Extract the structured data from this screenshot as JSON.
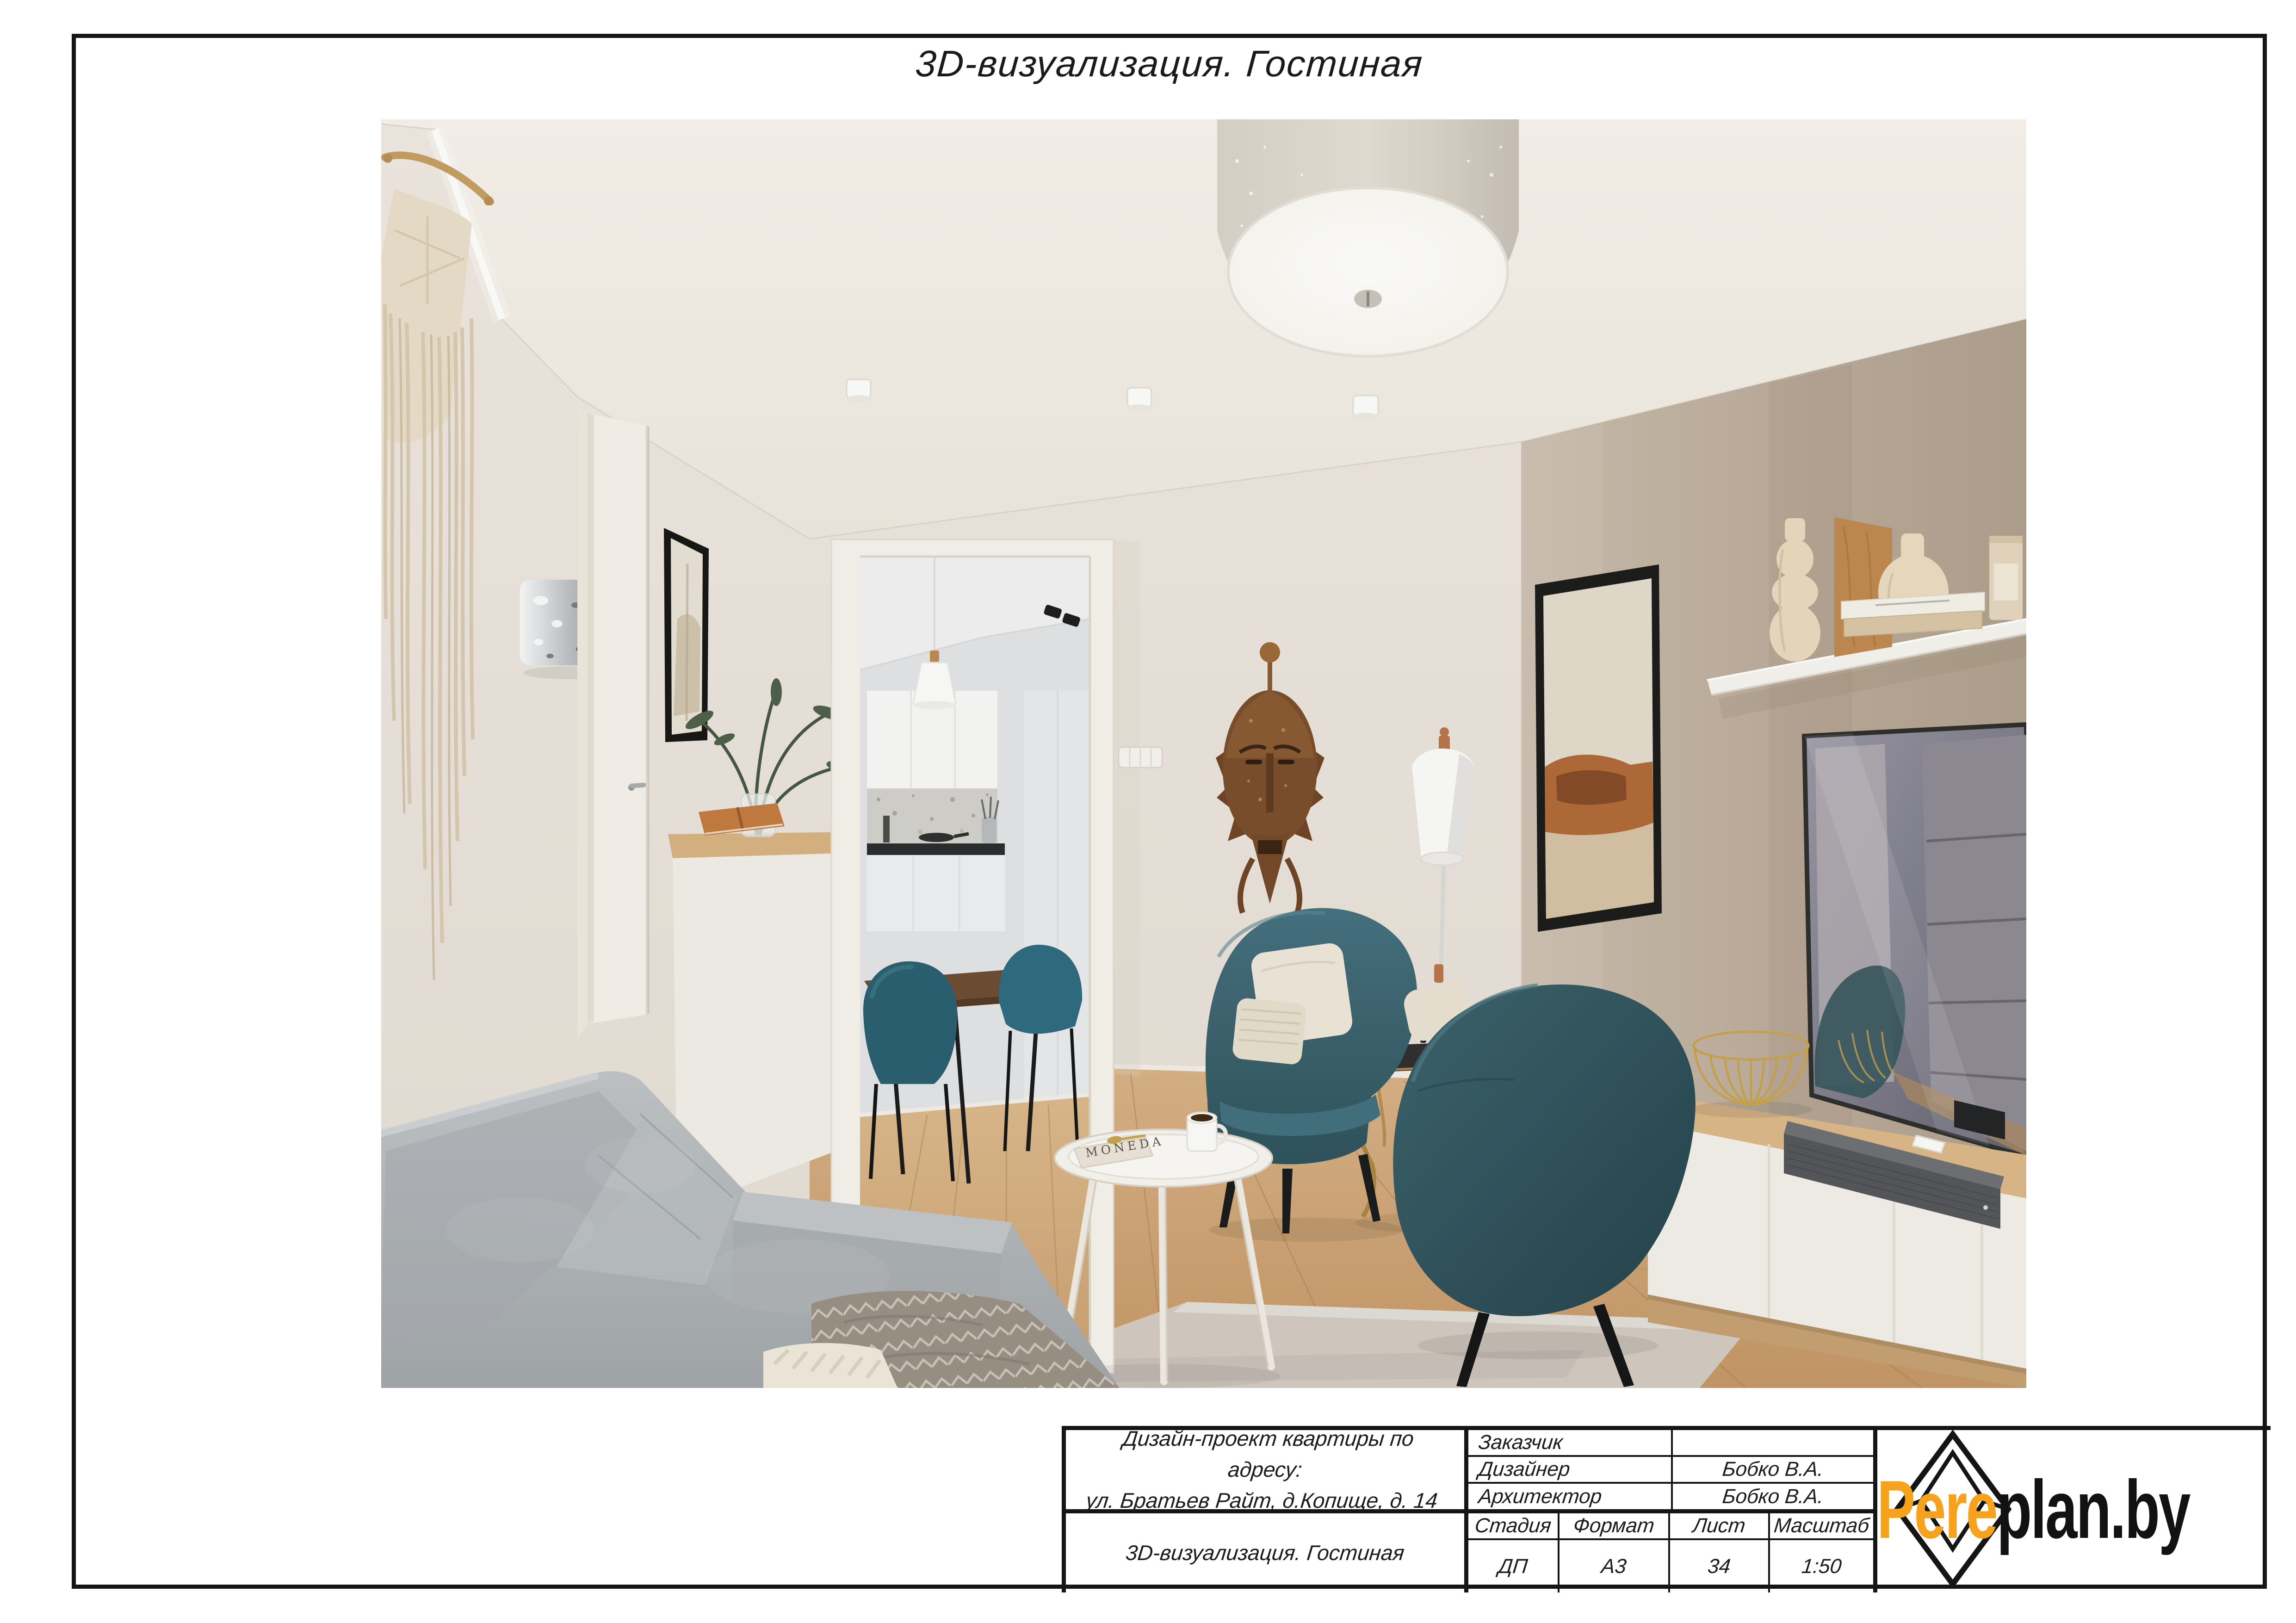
{
  "page": {
    "title": "3D-визуализация. Гостиная"
  },
  "title_block": {
    "project_lines": [
      "Дизайн-проект квартиры по адресу:",
      "ул. Братьев Райт, д.Копище, д. 14"
    ],
    "sheet_name": "3D-визуализация. Гостиная",
    "people": [
      {
        "role": "Заказчик",
        "name": ""
      },
      {
        "role": "Дизайнер",
        "name": "Бобко В.А."
      },
      {
        "role": "Архитектор",
        "name": "Бобко В.А."
      }
    ],
    "attrs": {
      "stage_label": "Стадия",
      "stage": "ДП",
      "format_label": "Формат",
      "format": "А3",
      "sheet_label": "Лист",
      "sheet": "34",
      "scale_label": "Масштаб",
      "scale": "1:50"
    }
  },
  "logo": {
    "prefix": "Pere",
    "suffix": "plan.by",
    "orange": "#F6A21D",
    "black": "#121212"
  },
  "render": {
    "book_text": "MONEDA",
    "colors": {
      "accent_teal": "#35606C",
      "wall_taupe": "#C3B5A5",
      "wood_floor": "#D2A97A",
      "sofa_gray": "#B2B6BA"
    }
  }
}
